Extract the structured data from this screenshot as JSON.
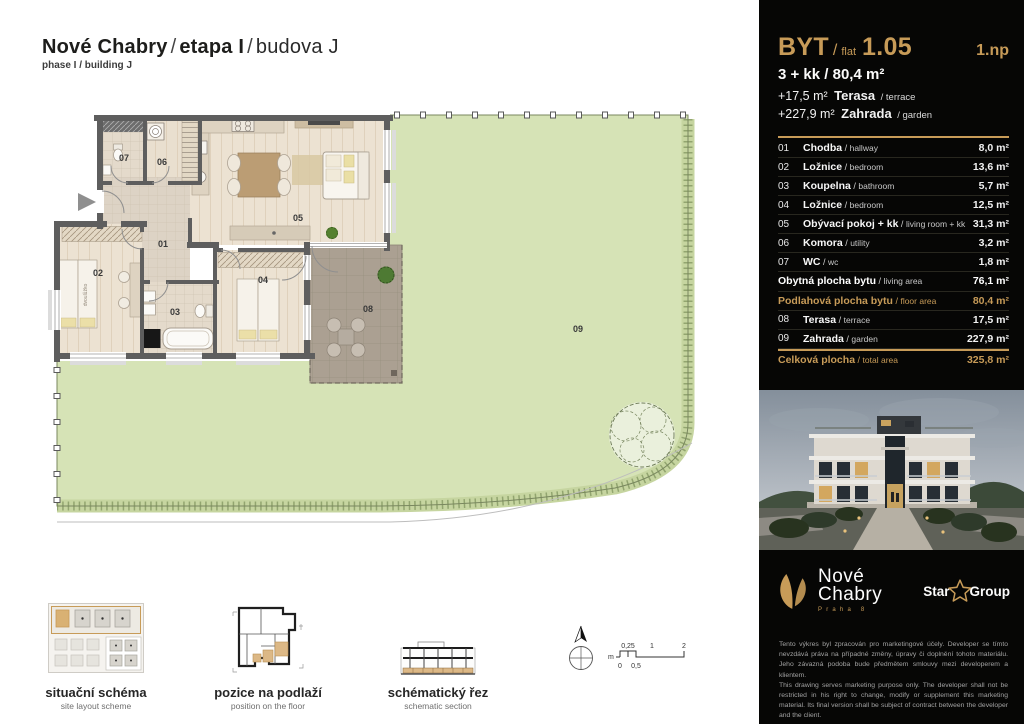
{
  "header": {
    "title_project": "Nové Chabry",
    "separator": "/",
    "title_phase": "etapa I",
    "title_building": "budova J",
    "subtitle": "phase I / building J"
  },
  "floorplan": {
    "labels": {
      "r01": "01",
      "r02": "02",
      "r03": "03",
      "r04": "04",
      "r05": "05",
      "r06": "06",
      "r07": "07",
      "r08": "08",
      "r09": "09"
    },
    "bed_label": "dvoulůžko"
  },
  "panel": {
    "flat_label": "BYT",
    "flat_word": "flat",
    "flat_no": "1.05",
    "floor": "1.np",
    "spec_main": "3 + kk / 80,4 m²",
    "spec_terrace_area": "+17,5 m²",
    "spec_terrace_name": "Terasa",
    "spec_terrace_en": "/ terrace",
    "spec_garden_area": "+227,9 m²",
    "spec_garden_name": "Zahrada",
    "spec_garden_en": "/ garden",
    "rows": [
      {
        "type": "room",
        "no": "01",
        "name": "Chodba",
        "en": "hallway",
        "area": "8,0 m²"
      },
      {
        "type": "room",
        "no": "02",
        "name": "Ložnice",
        "en": "bedroom",
        "area": "13,6 m²"
      },
      {
        "type": "room",
        "no": "03",
        "name": "Koupelna",
        "en": "bathroom",
        "area": "5,7 m²"
      },
      {
        "type": "room",
        "no": "04",
        "name": "Ložnice",
        "en": "bedroom",
        "area": "12,5 m²"
      },
      {
        "type": "room",
        "no": "05",
        "name": "Obývací pokoj + kk",
        "en": "living room + kk",
        "area": "31,3 m²"
      },
      {
        "type": "room",
        "no": "06",
        "name": "Komora",
        "en": "utility",
        "area": "3,2 m²"
      },
      {
        "type": "room",
        "no": "07",
        "name": "WC",
        "en": "wc",
        "area": "1,8 m²"
      },
      {
        "type": "summary",
        "name": "Obytná plocha bytu",
        "en": "living area",
        "area": "76,1 m²"
      },
      {
        "type": "summary-gold",
        "name": "Podlahová plocha bytu",
        "en": "floor area",
        "area": "80,4 m²"
      },
      {
        "type": "room",
        "no": "08",
        "name": "Terasa",
        "en": "terrace",
        "area": "17,5 m²"
      },
      {
        "type": "room",
        "no": "09",
        "name": "Zahrada",
        "en": "garden",
        "area": "227,9 m²"
      },
      {
        "type": "total",
        "name": "Celková plocha",
        "en": "total area",
        "area": "325,8 m²"
      }
    ],
    "logo": {
      "line1": "Nové",
      "line2": "Chabry",
      "sub": "Praha 8"
    },
    "partner": {
      "word1": "Star",
      "word2": "Group"
    },
    "legal": [
      "Tento výkres byl zpracován pro marketingové účely. Developer se tímto nevzdává práva na případné změny, úpravy či doplnění tohoto materiálu. Jeho závazná podoba bude předmětem smlouvy mezi developerem a klientem.",
      "This drawing serves marketing purpose only. The developer shall not be restricted in his right to change, modify or supplement this marketing material. Its final version shall be subject of contract between the developer and the client.",
      "Podlahová plocha bytu (ateliéru) je měřena dle nařízení vlády 366/2013 Sb.",
      "The floor area of the apartment (atelier) is measured according to the Government Degree No. 366/2013 Coll."
    ]
  },
  "footer": {
    "items": [
      {
        "cz": "situační schéma",
        "en": "site layout scheme"
      },
      {
        "cz": "pozice na podlaží",
        "en": "position on the floor"
      },
      {
        "cz": "schématický řez",
        "en": "schematic section"
      }
    ],
    "scale": {
      "unit": "m",
      "t1": "0,25",
      "t2": "1",
      "t3": "2",
      "b1": "0",
      "b2": "0,5"
    }
  },
  "colors": {
    "gold": "#c79b58",
    "garden": "#d6e3b6",
    "terrace": "#aba092",
    "wall": "#5e5e5e"
  }
}
